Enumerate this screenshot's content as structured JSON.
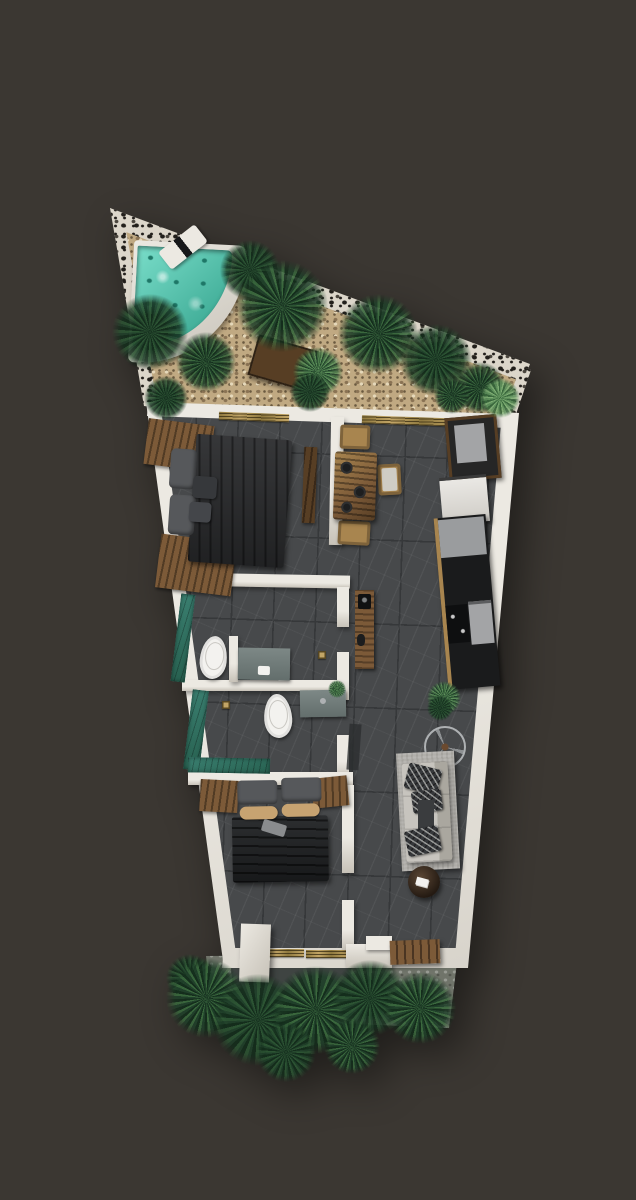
{
  "canvas": {
    "width": 636,
    "height": 1200
  },
  "colors": {
    "background": "#3b3732",
    "floor": "#47494b",
    "floor_joint": "#36383a",
    "floor_vein": "#83868a",
    "wall": "#ece9e2",
    "wall_shade": "#c7c2b8",
    "stone_light": "#dcd6ca",
    "stone_dark": "#221f1b",
    "gravel": "#c0a982",
    "gravel_dark": "#8a7354",
    "gravel_light": "#e5d8ba",
    "plant_dark": "#20402a",
    "plant_mid": "#3a683d",
    "plant_deep": "#142d1c",
    "plant_light": "#5f915c",
    "plant_pale": "#7fae74",
    "pool_water": "#79ddc9",
    "pool_deep": "#2f9e88",
    "wood": "#7c5a38",
    "wood_dark": "#573e24",
    "wood_light": "#a8854f",
    "gold": "#c2a566",
    "bed_dark": "#2b2c2e",
    "pillow_gray": "#56585b",
    "pillow_dark": "#36383b",
    "bolster_tan": "#c7a371",
    "sofa": "#c7c4be",
    "rug": "#b1afaa",
    "teal": "#3a7f70",
    "teal_dark": "#27604f",
    "counter_black": "#1a1b1c",
    "counter_gray": "#9a9c9e",
    "appliance_gray": "#a3a4a6",
    "appliance_white": "#eae8e4",
    "vanity_gray": "#636e6c",
    "toilet_white": "#f3f2ef",
    "terrace": "#70746a",
    "terrace_dark": "#3f4442",
    "metal": "#aeb1b3"
  },
  "vegetation": [
    {
      "name": "garden-palm",
      "x": 150,
      "y": 332,
      "r": 38,
      "variant": "dark"
    },
    {
      "name": "garden-palm",
      "x": 206,
      "y": 362,
      "r": 30,
      "variant": ""
    },
    {
      "name": "garden-palm",
      "x": 250,
      "y": 270,
      "r": 30,
      "variant": "dark"
    },
    {
      "name": "garden-palm",
      "x": 282,
      "y": 306,
      "r": 46,
      "variant": ""
    },
    {
      "name": "garden-shrub",
      "x": 318,
      "y": 372,
      "r": 25,
      "variant": "light"
    },
    {
      "name": "garden-palm",
      "x": 378,
      "y": 334,
      "r": 40,
      "variant": ""
    },
    {
      "name": "garden-palm",
      "x": 436,
      "y": 360,
      "r": 36,
      "variant": "dark"
    },
    {
      "name": "garden-palm",
      "x": 480,
      "y": 388,
      "r": 26,
      "variant": ""
    },
    {
      "name": "garden-monstera",
      "x": 500,
      "y": 398,
      "r": 20,
      "variant": "pale"
    },
    {
      "name": "garden-palm",
      "x": 166,
      "y": 398,
      "r": 22,
      "variant": "dark"
    },
    {
      "name": "garden-palm",
      "x": 310,
      "y": 392,
      "r": 20,
      "variant": "dark"
    },
    {
      "name": "garden-palm",
      "x": 452,
      "y": 396,
      "r": 18,
      "variant": ""
    },
    {
      "name": "kitchen-plant",
      "x": 444,
      "y": 698,
      "r": 17,
      "variant": "light"
    },
    {
      "name": "living-plant",
      "x": 440,
      "y": 708,
      "r": 13,
      "variant": "dark"
    },
    {
      "name": "vanity-plant",
      "x": 337,
      "y": 689,
      "r": 9,
      "variant": "light"
    },
    {
      "name": "entry-palm",
      "x": 190,
      "y": 978,
      "r": 24,
      "variant": "dark"
    },
    {
      "name": "entry-palm",
      "x": 206,
      "y": 998,
      "r": 40,
      "variant": ""
    },
    {
      "name": "entry-palm",
      "x": 258,
      "y": 1020,
      "r": 46,
      "variant": "dark"
    },
    {
      "name": "entry-palm",
      "x": 316,
      "y": 1010,
      "r": 44,
      "variant": ""
    },
    {
      "name": "entry-palm",
      "x": 370,
      "y": 998,
      "r": 38,
      "variant": "dark"
    },
    {
      "name": "entry-palm",
      "x": 420,
      "y": 1008,
      "r": 36,
      "variant": ""
    },
    {
      "name": "entry-palm",
      "x": 286,
      "y": 1052,
      "r": 30,
      "variant": "dark"
    },
    {
      "name": "entry-palm",
      "x": 352,
      "y": 1046,
      "r": 28,
      "variant": ""
    }
  ]
}
